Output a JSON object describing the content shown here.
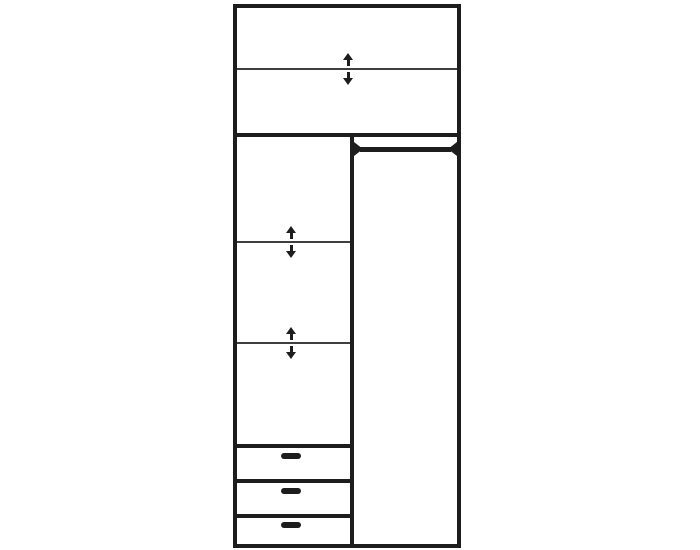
{
  "page": {
    "background_color": "#ffffff"
  },
  "diagram": {
    "kind": "wardrobe-interior-line-drawing",
    "ink_color": "#1d1d1d",
    "shelf_line_color": "#3f3f3f",
    "top_compartment": {
      "adjustable_shelves": 1
    },
    "left_column": {
      "adjustable_shelves": 2,
      "drawers": 3
    },
    "right_column": {
      "hanging_rails": 1
    },
    "icons": {
      "arrow_up": "arrow-up-icon",
      "arrow_down": "arrow-down-icon",
      "rail": "hanging-rail-icon",
      "handle": "drawer-handle-icon"
    }
  }
}
